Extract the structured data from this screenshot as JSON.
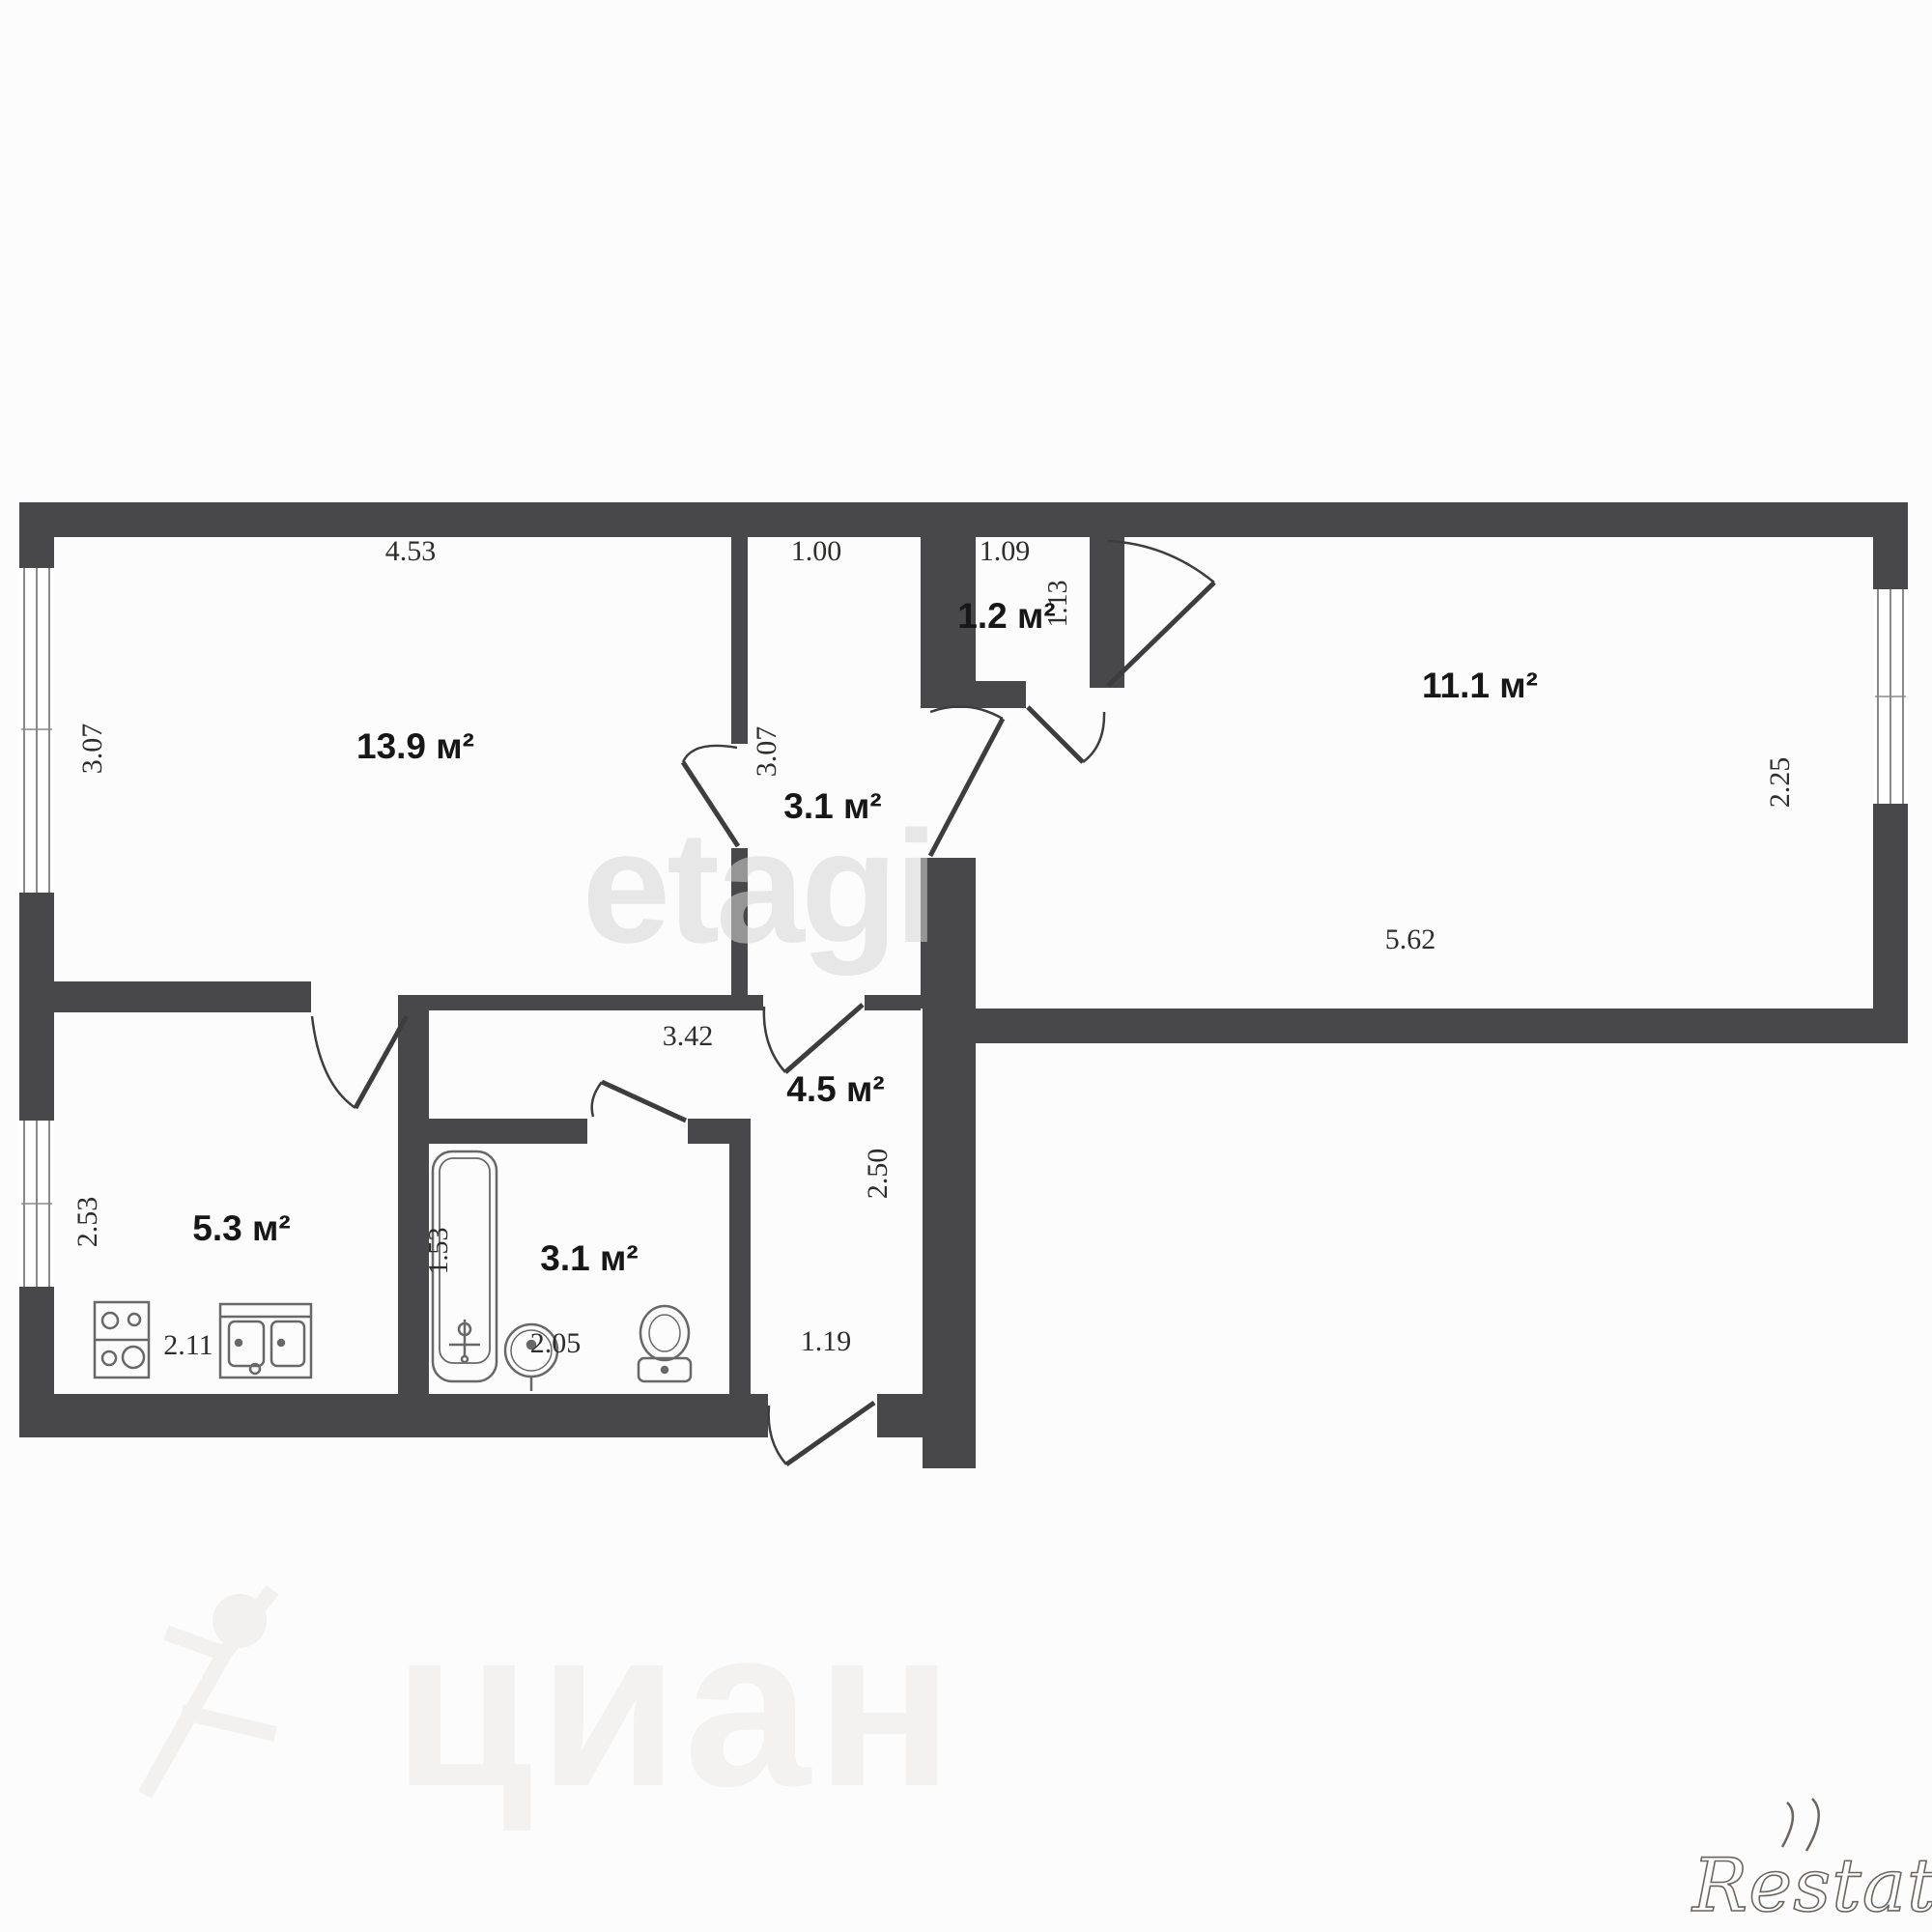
{
  "plan": {
    "rooms": [
      {
        "id": "living-room",
        "area": "13.9 м²"
      },
      {
        "id": "corridor",
        "area": "3.1 м²"
      },
      {
        "id": "storage",
        "area": "1.2 м²"
      },
      {
        "id": "bedroom",
        "area": "11.1 м²"
      },
      {
        "id": "kitchen",
        "area": "5.3 м²"
      },
      {
        "id": "bathroom",
        "area": "3.1 м²"
      },
      {
        "id": "hallway",
        "area": "4.5 м²"
      }
    ],
    "dimensions": {
      "living_width": "4.53",
      "living_depth": "3.07",
      "corridor_width": "1.00",
      "corridor_depth": "3.07",
      "storage_width": "1.09",
      "storage_depth": "1.13",
      "bedroom_width": "5.62",
      "bedroom_depth": "2.25",
      "kitchen_width": "2.11",
      "kitchen_depth": "2.53",
      "bathroom_width": "2.05",
      "bathtub_length": "1.53",
      "hallway_width": "3.42",
      "hallway_depth": "2.50",
      "entry_door_width": "1.19"
    },
    "fixtures": [
      "stove",
      "kitchen-sink",
      "bathtub",
      "wash-basin",
      "toilet"
    ]
  },
  "watermarks": {
    "center": "etagi",
    "bottom": "циан",
    "corner_logo": "Restate"
  },
  "colors": {
    "wall": "#48484a",
    "fixture_line": "#686868",
    "door_line": "#3d3d3f",
    "window_line": "#8a8a8a",
    "dim_text": "#2e2d2b",
    "area_text": "#171717",
    "watermark_center": "#d6d6d6",
    "watermark_bottom": "#f1f0ee",
    "logo": "#6b6560"
  }
}
